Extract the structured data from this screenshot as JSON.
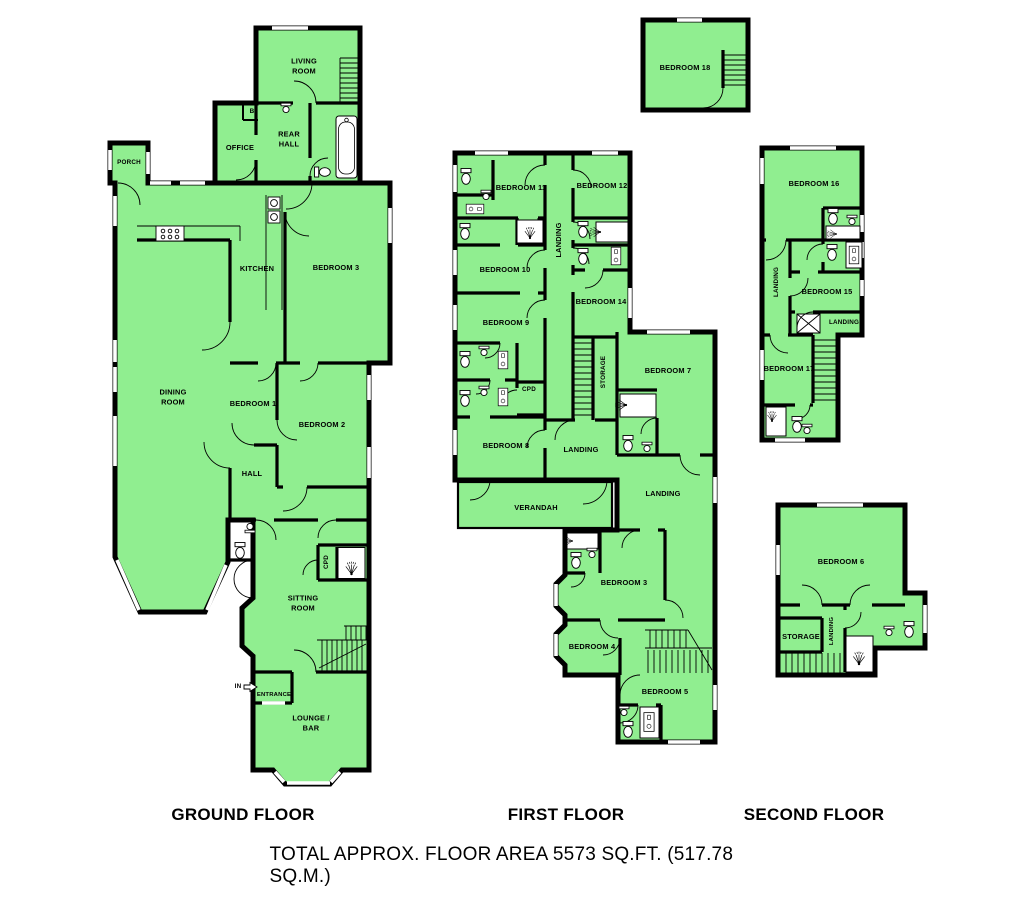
{
  "colors": {
    "room_fill": "#90EE90",
    "wall": "#000000",
    "background": "#FFFFFF"
  },
  "footer": {
    "total_area": "TOTAL APPROX. FLOOR AREA 5573 SQ.FT. (517.78 SQ.M.)"
  },
  "floors": {
    "ground": {
      "title": "GROUND FLOOR",
      "rooms": {
        "living_room": "LIVING\nROOM",
        "b": "B",
        "office": "OFFICE",
        "rear_hall": "REAR\nHALL",
        "porch": "PORCH",
        "kitchen": "KITCHEN",
        "bedroom_3": "BEDROOM 3",
        "dining_room": "DINING\nROOM",
        "bedroom_1": "BEDROOM 1",
        "bedroom_2": "BEDROOM 2",
        "hall": "HALL",
        "cpd": "CPD",
        "sitting_room": "SITTING\nROOM",
        "in_marker": "IN",
        "entrance": "ENTRANCE",
        "lounge_bar": "LOUNGE /\nBAR"
      }
    },
    "first": {
      "title": "FIRST FLOOR",
      "rooms": {
        "bedroom_18": "BEDROOM 18",
        "bedroom_11": "BEDROOM 11",
        "bedroom_12": "BEDROOM 12",
        "landing_top": "LANDING",
        "bedroom_10": "BEDROOM 10",
        "bedroom_14": "BEDROOM 14",
        "bedroom_9": "BEDROOM 9",
        "storage": "STORAGE",
        "bedroom_7": "BEDROOM 7",
        "cpd": "CPD",
        "bedroom_8": "BEDROOM 8",
        "landing_mid": "LANDING",
        "verandah": "VERANDAH",
        "landing_right": "LANDING",
        "bedroom_3": "BEDROOM 3",
        "bedroom_4": "BEDROOM 4",
        "bedroom_5": "BEDROOM 5"
      }
    },
    "second": {
      "title": "SECOND FLOOR",
      "rooms": {
        "bedroom_16": "BEDROOM 16",
        "landing_upper": "LANDING",
        "bedroom_15": "BEDROOM 15",
        "landing_mid": "LANDING",
        "bedroom_17": "BEDROOM 17",
        "bedroom_6": "BEDROOM 6",
        "storage": "STORAGE",
        "landing_lower": "LANDING"
      }
    }
  }
}
